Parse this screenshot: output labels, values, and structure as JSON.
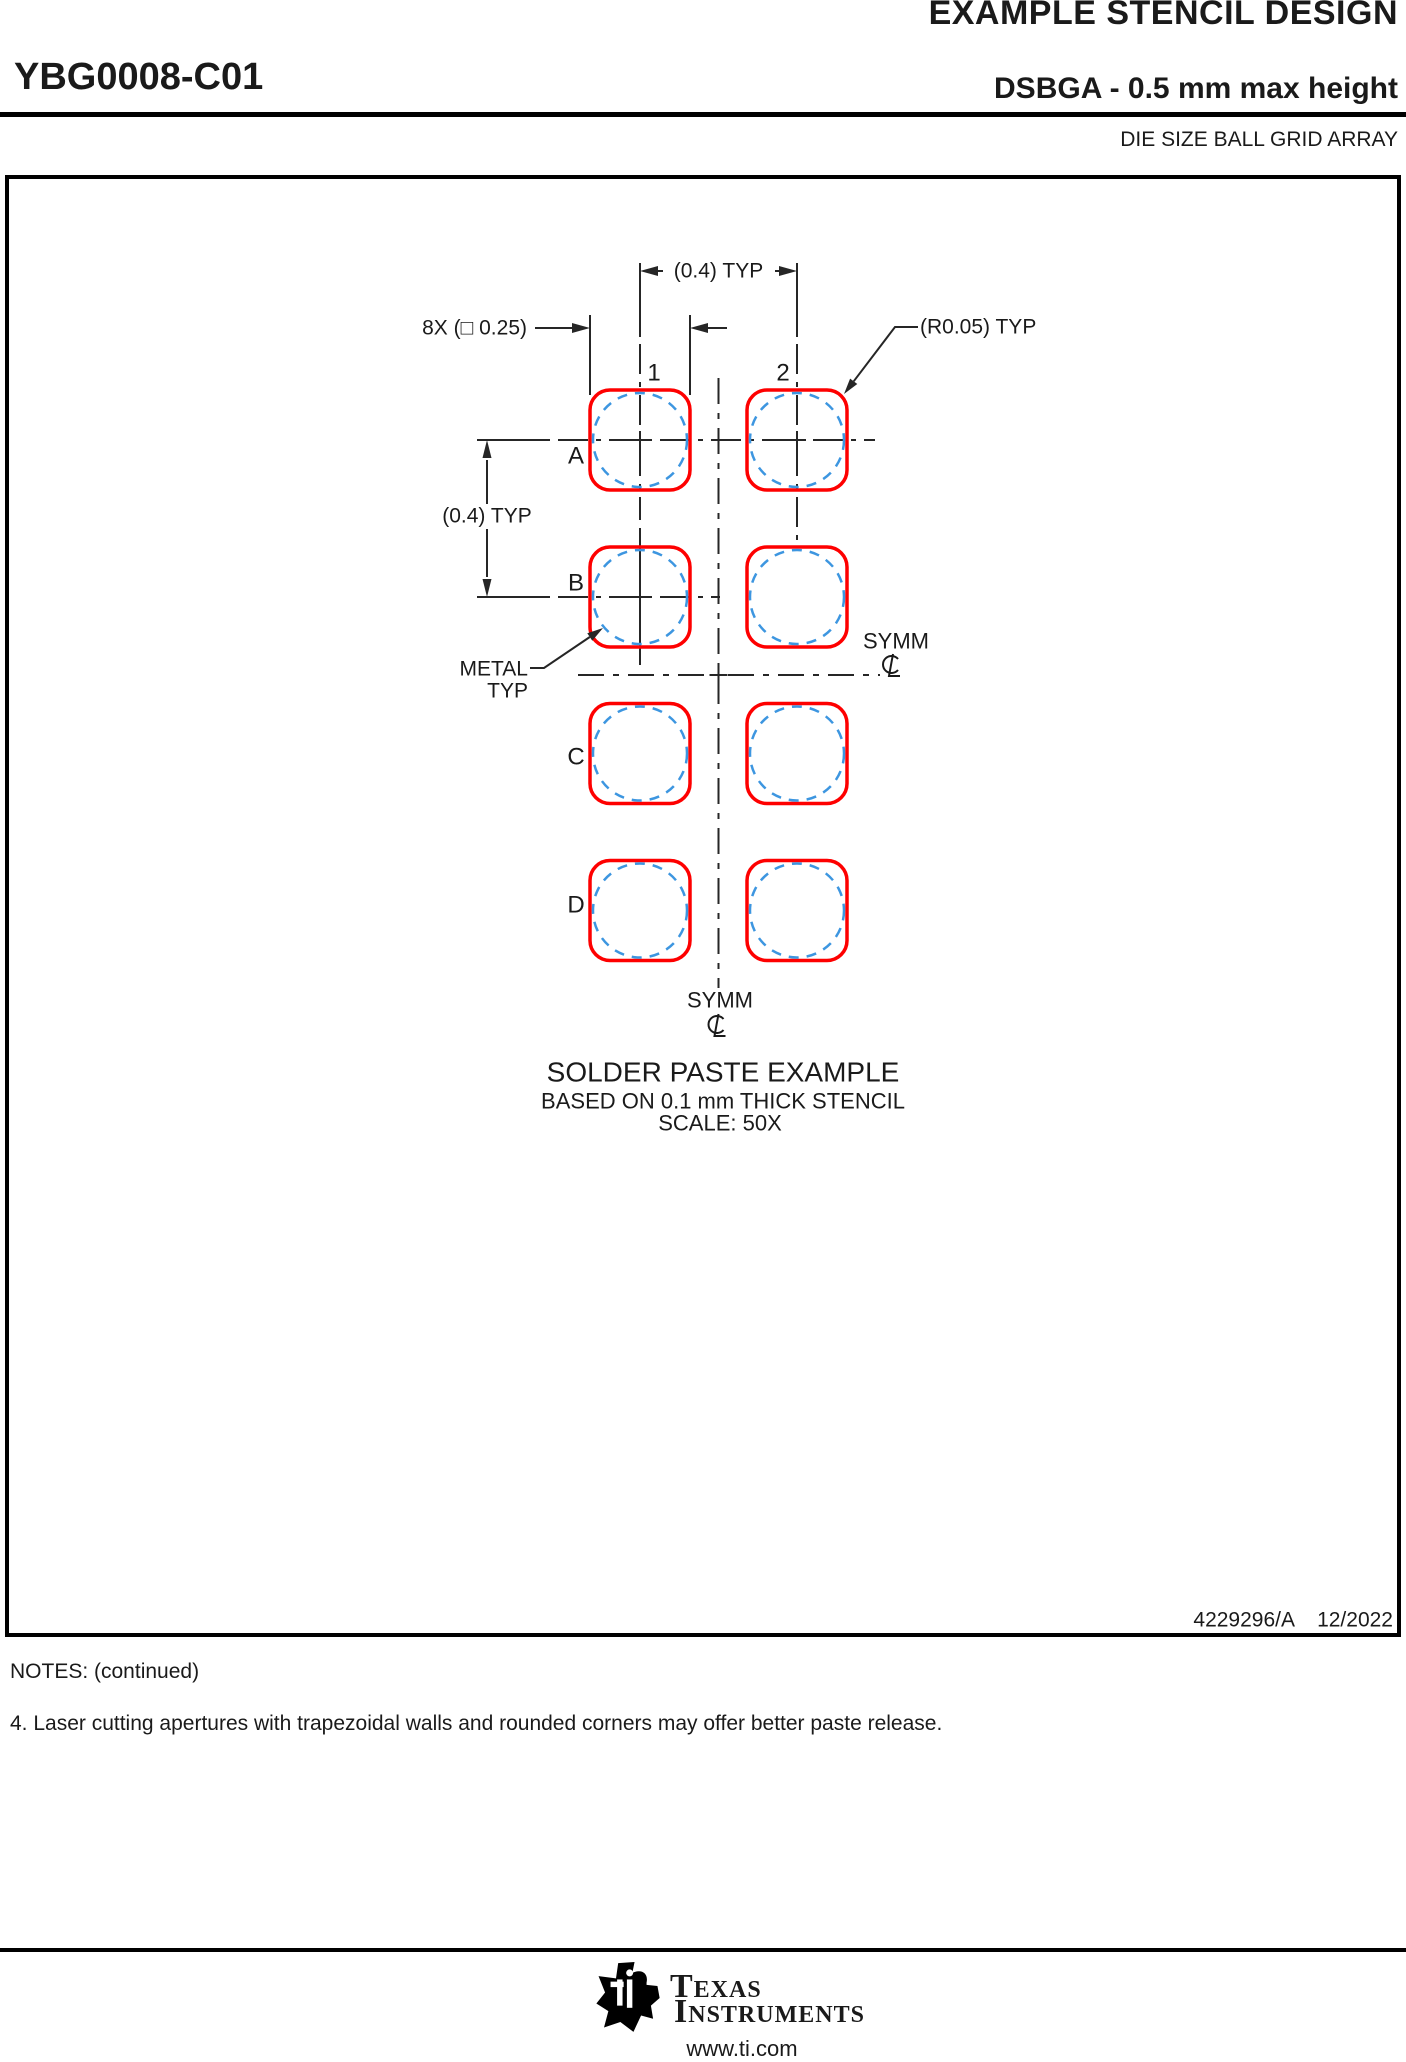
{
  "header": {
    "doc_title": "EXAMPLE STENCIL DESIGN",
    "part_number": "YBG0008-C01",
    "package_line": "DSBGA - 0.5 mm max height",
    "package_family": "DIE SIZE BALL GRID ARRAY"
  },
  "drawing": {
    "dim_pitch_horizontal": "(0.4) TYP",
    "dim_pitch_vertical": "(0.4) TYP",
    "dim_aperture": "8X (□ 0.25)",
    "dim_corner_radius": "(R0.05) TYP",
    "metal_label_line1": "METAL",
    "metal_label_line2": "TYP",
    "symm_right_label": "SYMM",
    "symm_bottom_label": "SYMM",
    "col_labels": [
      "1",
      "2"
    ],
    "row_labels": [
      "A",
      "B",
      "C",
      "D"
    ],
    "title": "SOLDER PASTE EXAMPLE",
    "subtitle": "BASED ON 0.1 mm THICK STENCIL",
    "scale_note": "SCALE: 50X",
    "doc_number": "4229296/A",
    "revision_date": "12/2022",
    "colors": {
      "aperture_outline": "#fe0000",
      "metal_pad_dashed": "#3d96e0",
      "drawing_lines": "#262626"
    }
  },
  "notes": {
    "heading": "NOTES: (continued)",
    "items": [
      "4. Laser cutting apertures with trapezoidal walls and rounded corners may offer better paste release."
    ]
  },
  "footer": {
    "brand_top": "Texas",
    "brand_bottom": "Instruments",
    "website": "www.ti.com"
  }
}
